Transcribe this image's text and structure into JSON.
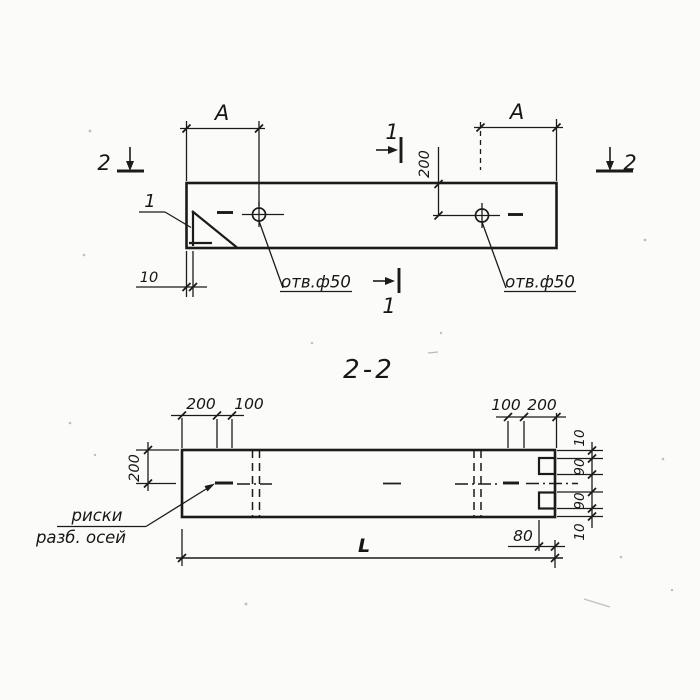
{
  "colors": {
    "ink": "#1b1b1b",
    "paper": "#fbfbf9"
  },
  "plan": {
    "dim_a_left": "А",
    "dim_a_right": "А",
    "dim_200": "200",
    "dim_10": "10",
    "hole_label_left": "отв.ф50",
    "hole_label_right": "отв.ф50",
    "section_mark_top": "1",
    "section_mark_bottom": "1",
    "section_mark_left": "2",
    "section_mark_right": "2",
    "detail_callout": "1"
  },
  "section": {
    "title": "2-2",
    "dim_height": "200",
    "dims_top_left": [
      "200",
      "100"
    ],
    "dims_top_right": [
      "100",
      "200"
    ],
    "dims_right": [
      "10",
      "90",
      "90",
      "10"
    ],
    "dim_80": "80",
    "dim_length": "L",
    "axis_note": [
      "риски",
      "разб. осей"
    ]
  }
}
